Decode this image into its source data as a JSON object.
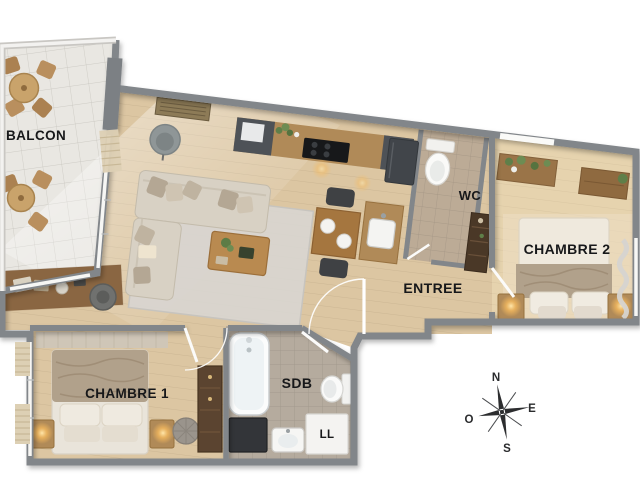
{
  "scene": {
    "type": "apartment-floor-plan-3d-render",
    "width": 640,
    "height": 480
  },
  "labels": {
    "balcony": "BALCON",
    "bedroom1": "CHAMBRE 1",
    "bedroom2": "CHAMBRE 2",
    "wc": "WC",
    "entrance": "ENTREE",
    "bathroom": "SDB",
    "washing_machine": "LL"
  },
  "compass": {
    "north": "N",
    "east": "E",
    "south": "S",
    "west": "O"
  },
  "palette": {
    "wall": "#82868a",
    "wood_floor": "#dcc6a2",
    "bedroom2_floor": "#e6d3ae",
    "balcony_floor": "#e9e7e2",
    "bathroom_floor": "#b5ab9e",
    "wc_floor": "#bcab96",
    "rug": "#d8d5d0",
    "sofa": "#d8d1c4",
    "kitchen_cabinet_dark": "#4e5257",
    "wood_furniture": "#b08a58",
    "wardrobe_dark": "#5b4430",
    "blanket": "#b1a18b",
    "label_text": "#17181a",
    "lamp_glow": "#ffc76e",
    "white_fixture": "#f6f6f4"
  },
  "rooms": [
    {
      "name": "balcon",
      "label_key": "balcony",
      "furniture": [
        "bistro-table",
        "bistro-chairs",
        "bistro-table",
        "bistro-chairs"
      ]
    },
    {
      "name": "sejour-cuisine",
      "furniture": [
        "corner-sofa",
        "throw-pillows",
        "armchair",
        "coffee-table",
        "area-rug",
        "desk",
        "desk-chair",
        "ceiling-vent",
        "kitchen-counter",
        "cooktop",
        "fridge",
        "kitchen-sink",
        "dining-table",
        "dining-chairs",
        "plants"
      ]
    },
    {
      "name": "wc",
      "label_key": "wc",
      "furniture": [
        "toilet"
      ]
    },
    {
      "name": "entree",
      "label_key": "entrance",
      "furniture": [
        "entry-door",
        "shelving-unit"
      ]
    },
    {
      "name": "chambre-2",
      "label_key": "bedroom2",
      "furniture": [
        "double-bed",
        "pillows",
        "nightstand",
        "lamp",
        "nightstand",
        "lamp",
        "plant-shelf",
        "dresser",
        "window-curtains"
      ]
    },
    {
      "name": "chambre-1",
      "label_key": "bedroom1",
      "furniture": [
        "double-bed",
        "pillows",
        "nightstand",
        "lamp",
        "nightstand",
        "lamp",
        "wardrobe",
        "pouf",
        "window-blinds"
      ]
    },
    {
      "name": "sdb",
      "label_key": "bathroom",
      "furniture": [
        "bathtub",
        "washbasin",
        "toilet",
        "washing-machine",
        "cabinet"
      ]
    }
  ]
}
